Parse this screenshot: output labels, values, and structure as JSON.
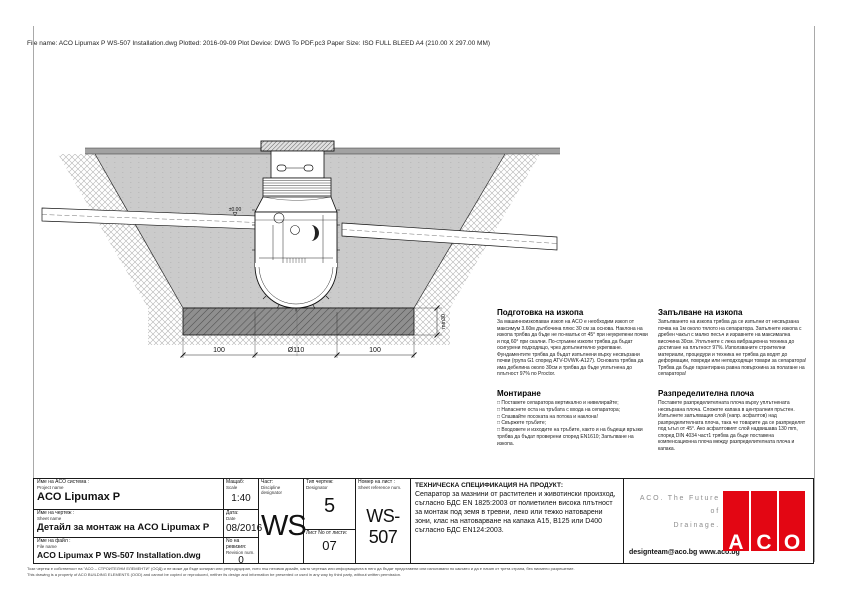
{
  "meta": {
    "file_info": "File name: ACO Lipumax P WS-507 Installation.dwg   Plotted: 2016-09-09   Plot Device: DWG To PDF.pc3   Paper Size: ISO FULL BLEED A4 (210.00 X 297.00 MM)"
  },
  "drawing": {
    "level_marker": "±0.00",
    "dim_left": "100",
    "dim_center": "Ø110",
    "dim_right": "100",
    "dim_base": "min30"
  },
  "notes": {
    "prep": {
      "title": "Подготовка на изкопа",
      "body": "За машинноизкопаван изкоп на ACO е необходим изкоп от максимум 3.60м дълбочина плюс 30 см за основа. Наклона на изкопа трябва да бъде не по-малък от 45° при неукрепени почви и под 60° при скални. По-стръмни изкопи трябва да бъдат осигурени подходящо, чрез допълнително укрепване. Фундаментите трябва да бъдат изпълнени върху несвързани почви (група G1 според ATV-DVWK-A127). Основата трябва да има дебелина около 30см и трябва да бъде уплътнена до плътност 97% по Proctor."
    },
    "backfill": {
      "title": "Запълване на изкопа",
      "body": "Запълването на изкопа трябва да се изпълни от несвързана почва на 1м около тялото на сепаратора. Запълнете изкопа с дребен чакъл с малко песъч и изравнете на максимална височина 30см. Уплътнете с лека вибрационна техника до достигане на плътност 97%. Използваните строителни материали, процедури и техника не трябва да водят до деформации, повреди или неподходящи товари за сепаратора! Трябва да бъде гарантирана равна повърхнина за полагане на сепаратора!"
    },
    "mounting": {
      "title": "Монтиране",
      "items": [
        "□ Поставете сепаратора вертикално и нивелирайте;",
        "□ Напаснете оста на тръбата с входа на сепаратора;",
        "□ Спазвайте посоката на потока и наклона!",
        "□ Свържете тръбите;",
        "□ Входовете и изходите на тръбите, както и на бъдещи връзки трябва да бъдат проверени според EN1610; Запълване на изкопа."
      ]
    },
    "plate": {
      "title": "Разпределителна плоча",
      "body": "Поставете разпределителната плоча върху уплътнената несвързана плоча. Сложете капака в централния пръстен. Изпълнете запълващия слой (напр. асфалтов) над разпределителната плоча, така че товарите да се разпределят под ъгъл от 45°. Ако асфалтовият слой надвишава 130 mm, според DIN 4034 част1 трябва да бъде поставена компенсационна плоча между разпределителната плоча и капака."
    }
  },
  "titleblock": {
    "project": {
      "label_bg": "Име на ACO система :",
      "label_en": "Project name",
      "value": "ACO Lipumax P"
    },
    "scale": {
      "label_bg": "Мащаб:",
      "label_en": "Scale",
      "value": "1:40"
    },
    "sheet": {
      "label_bg": "Име на чертеж :",
      "label_en": "Sheet name",
      "value": "Детайл за монтаж на ACO Lipumax P"
    },
    "date": {
      "label_bg": "Дата:",
      "label_en": "Date",
      "value": "08/2016"
    },
    "file": {
      "label_bg": "Име на файл :",
      "label_en": "File name",
      "value": "ACO Lipumax P WS-507 Installation.dwg"
    },
    "revision": {
      "label_bg": "No на ревизия:",
      "label_en": "Revision num.",
      "value": "0"
    },
    "discipline": {
      "label_bg": "Част:",
      "label_en": "Discipline designator",
      "value": "WS"
    },
    "dtype": {
      "label_bg": "Тип чертеж:",
      "label_en": "Designator",
      "value": "5"
    },
    "sheet_no": {
      "label": "Лист No от листи:",
      "value": "07"
    },
    "ref": {
      "label_bg": "Номер на лист :",
      "label_en": "Sheet reference num.",
      "value": "WS-507"
    },
    "spec_title": "ТЕХНИЧЕСКА СПЕЦИФИКАЦИЯ НА ПРОДУКТ:",
    "spec_body": "Сепаратор за мазнини от растителен и животински произход, съгласно БДС EN 1825:2003 от полиетилен висока плътност за монтаж под земя в тревни, леко или тежко натоварени зони, клас на натоварване на капака A15, B125 или D400 съгласно БДС EN124:2003.",
    "slogan_line1": "ACO. The Future of",
    "slogan_line2": "Drainage.",
    "contacts": "designteam@aco.bg  www.aco.bg",
    "logo_letter_a": "A",
    "logo_letter_c": "C",
    "logo_letter_o": "O",
    "brand_red": "#e30613"
  },
  "footer": {
    "line_bg": "Този чертеж е собственост на \"АСО – СТРОИТЕЛНИ ЕЛЕМЕНТИ\" (ООД) и не може да бъде копиран или репродуциран, нито пък неговия дизайн, както чертежа или информацията в него да бъдат представени или използвани по какъвто и да е начин от трета страна, без писмено разрешение.",
    "line_en": "This drawing is a property of ACO BUILDING ELEMENTS (OOD) and cannot be copied or reproduced, neither its design and information be presented or used in any way by third party, without written permission."
  }
}
